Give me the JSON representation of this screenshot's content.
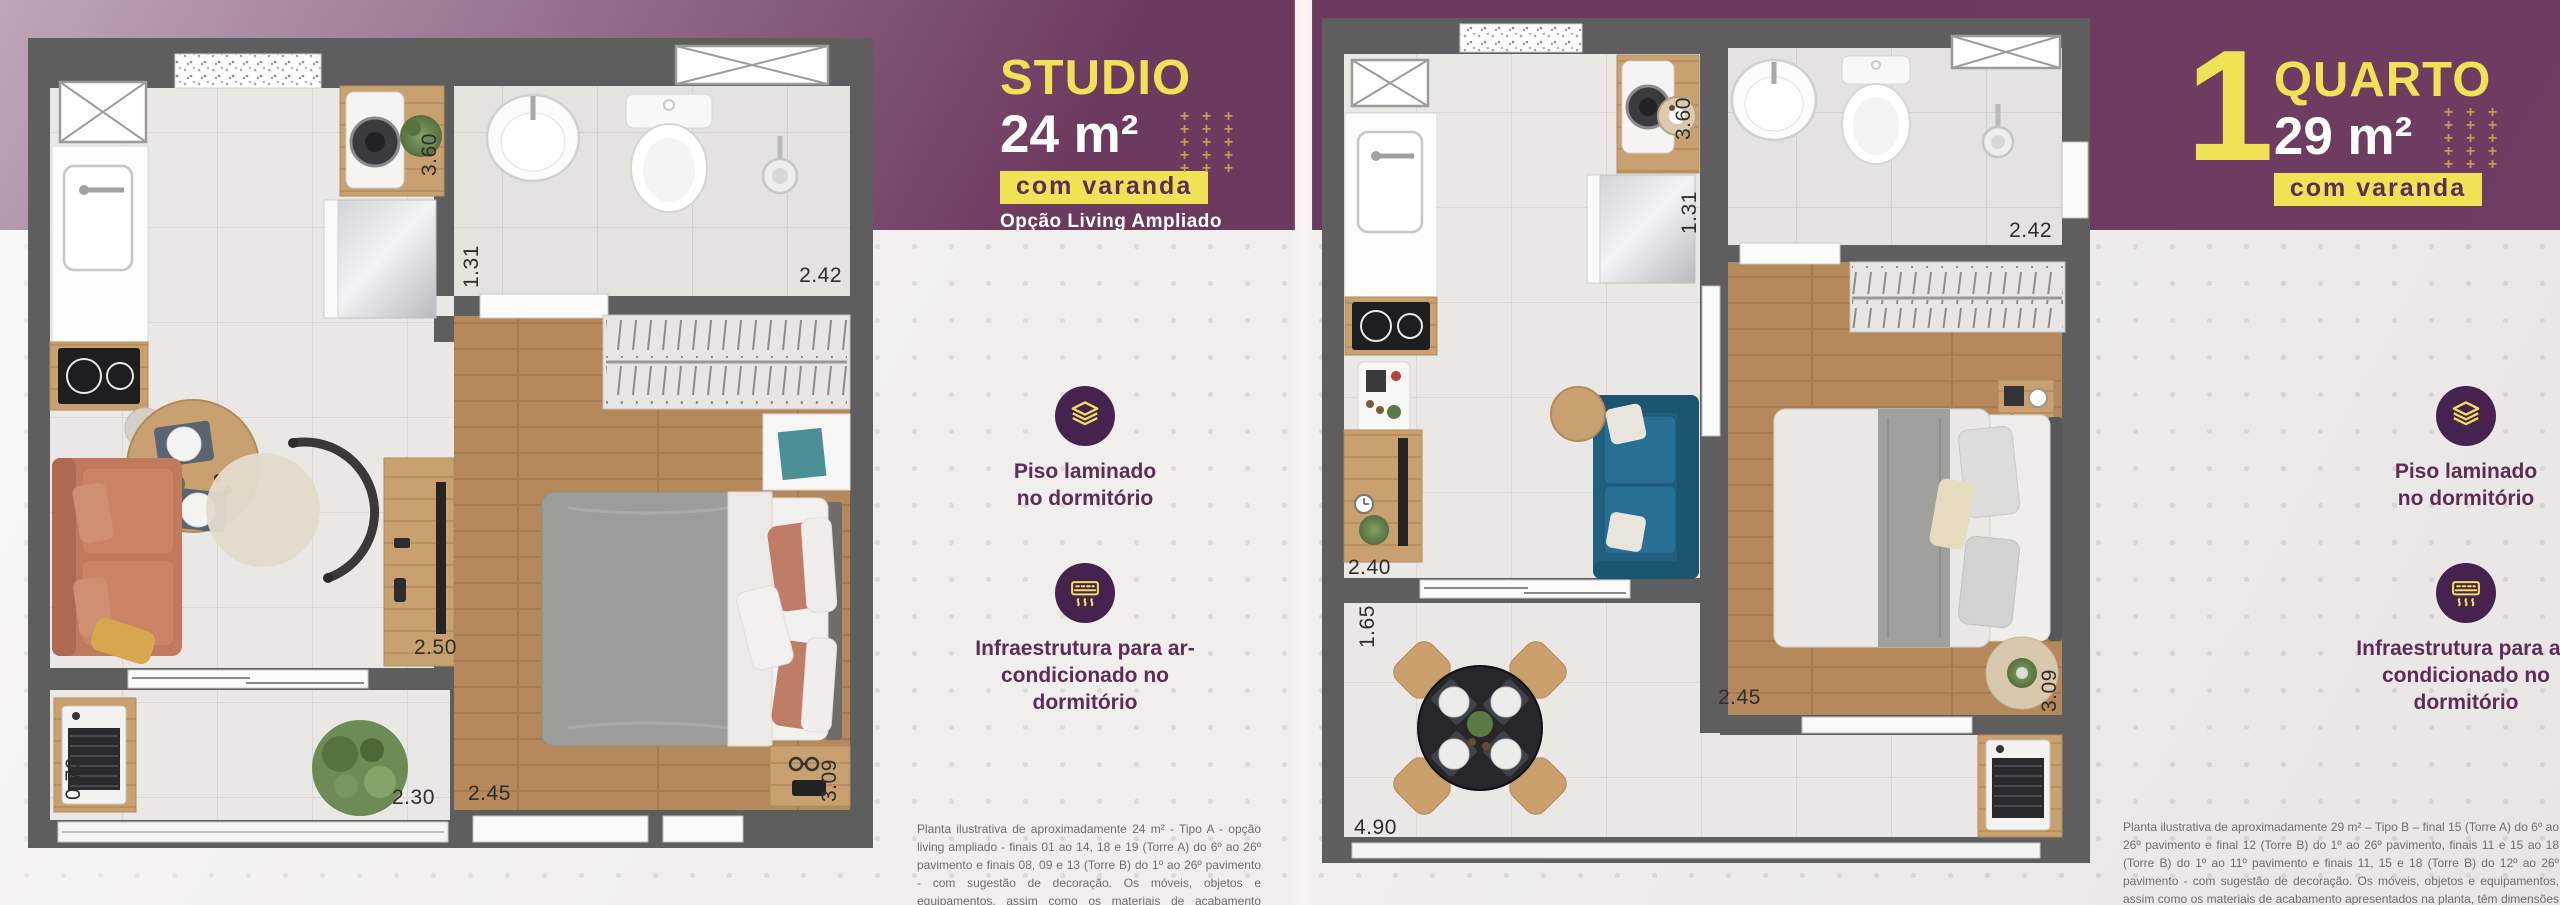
{
  "decor": {
    "plus_glyph": "+",
    "plus_rows": 5,
    "plus_cols": 3
  },
  "left": {
    "title": "STUDIO",
    "area": "24 m²",
    "badge": "com varanda",
    "option": "Opção Living Ampliado",
    "dims": {
      "w360": "3.60",
      "w131": "1.31",
      "w242": "2.42",
      "w250": "2.50",
      "w245": "2.45",
      "w309": "3.09",
      "w230": "2.30",
      "w070": "0.70"
    },
    "disclaimer": "Planta ilustrativa de aproximadamente 24 m² - Tipo A - opção living ampliado - finais 01 ao 14, 18 e 19 (Torre A) do 6º ao 26º pavimento e finais 08, 09 e 13 (Torre B) do 1º ao 26º pavimento - com sugestão de decoração. Os móveis, objetos e equipamentos, assim como os materiais de acabamento apresentados na planta, têm dimensões comerciais e não são parte integrante do contrato."
  },
  "right": {
    "number": "1",
    "title": "QUARTO",
    "area": "29 m²",
    "badge": "com varanda",
    "dims": {
      "w360": "3.60",
      "w131": "1.31",
      "w242": "2.42",
      "w240": "2.40",
      "w165": "1.65",
      "w490": "4.90",
      "w245": "2.45",
      "w309": "3.09"
    },
    "disclaimer": "Planta ilustrativa de aproximadamente 29 m² – Tipo B – final 15 (Torre A) do 6º ao 26º pavimento e final 12 (Torre B) do 1º ao 26º pavimento, finais 11 e 15 ao 18 (Torre B) do 1º ao 11º pavimento e finais 11, 15 e 18 (Torre B) do 12º ao 26º pavimento - com sugestão de decoração. Os móveis, objetos e equipamentos, assim como os materiais de acabamento apresentados na planta, têm dimensões comerciais e não são parte integrante do contrato."
  },
  "features": [
    {
      "icon": "laminate-layers-icon",
      "label": "Piso laminado no dormitório"
    },
    {
      "icon": "air-conditioner-icon",
      "label": "Infraestrutura para ar-condicionado no dormitório"
    }
  ],
  "colors": {
    "purple": "#6d3a5f",
    "yellow": "#f0e155",
    "badge_text": "#5e2c56",
    "icon_circle": "#46224e",
    "wall_gray": "#5f5e5e",
    "teal_sofa": "#20607e",
    "terracotta_sofa": "#c17a5e",
    "wood": "#b5895c"
  }
}
